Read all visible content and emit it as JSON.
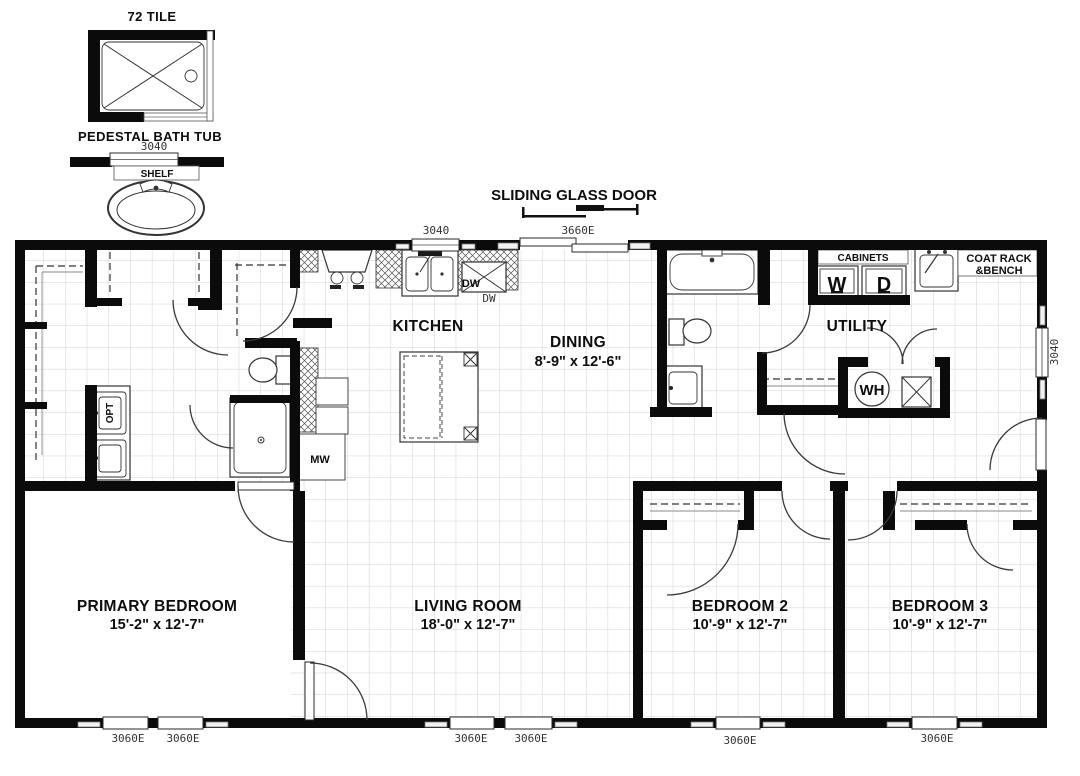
{
  "detail": {
    "title": "72 TILE",
    "caption": "PEDESTAL BATH TUB",
    "window": "3040",
    "shelf": "SHELF"
  },
  "callout": {
    "sliding_door": "SLIDING GLASS DOOR"
  },
  "windows": {
    "kitchen_top": "3040",
    "sliding": "3660E",
    "right": "3040",
    "b1": "3060E",
    "b2": "3060E",
    "b3": "3060E",
    "b4": "3060E",
    "b5": "3060E",
    "b6": "3060E"
  },
  "rooms": {
    "kitchen": {
      "name": "KITCHEN"
    },
    "dining": {
      "name": "DINING",
      "dims": "8'-9\" x 12'-6\""
    },
    "utility": {
      "name": "UTILITY"
    },
    "primary": {
      "name": "PRIMARY BEDROOM",
      "dims": "15'-2\" x 12'-7\""
    },
    "living": {
      "name": "LIVING ROOM",
      "dims": "18'-0\" x 12'-7\""
    },
    "bed2": {
      "name": "BEDROOM 2",
      "dims": "10'-9\" x 12'-7\""
    },
    "bed3": {
      "name": "BEDROOM 3",
      "dims": "10'-9\" x 12'-7\""
    }
  },
  "labels": {
    "cabinets": "CABINETS",
    "washer": "W",
    "dryer": "D",
    "coat1": "COAT RACK",
    "coat2": "&BENCH",
    "wh": "WH",
    "mw": "MW",
    "dw": "DW",
    "dw2": "DW",
    "opt": "OPT"
  },
  "colors": {
    "walls": "#0b0b0b",
    "grid": "#d2d2d2",
    "background": "#ffffff",
    "text": "#0d0d0d",
    "window_text": "#333333"
  }
}
